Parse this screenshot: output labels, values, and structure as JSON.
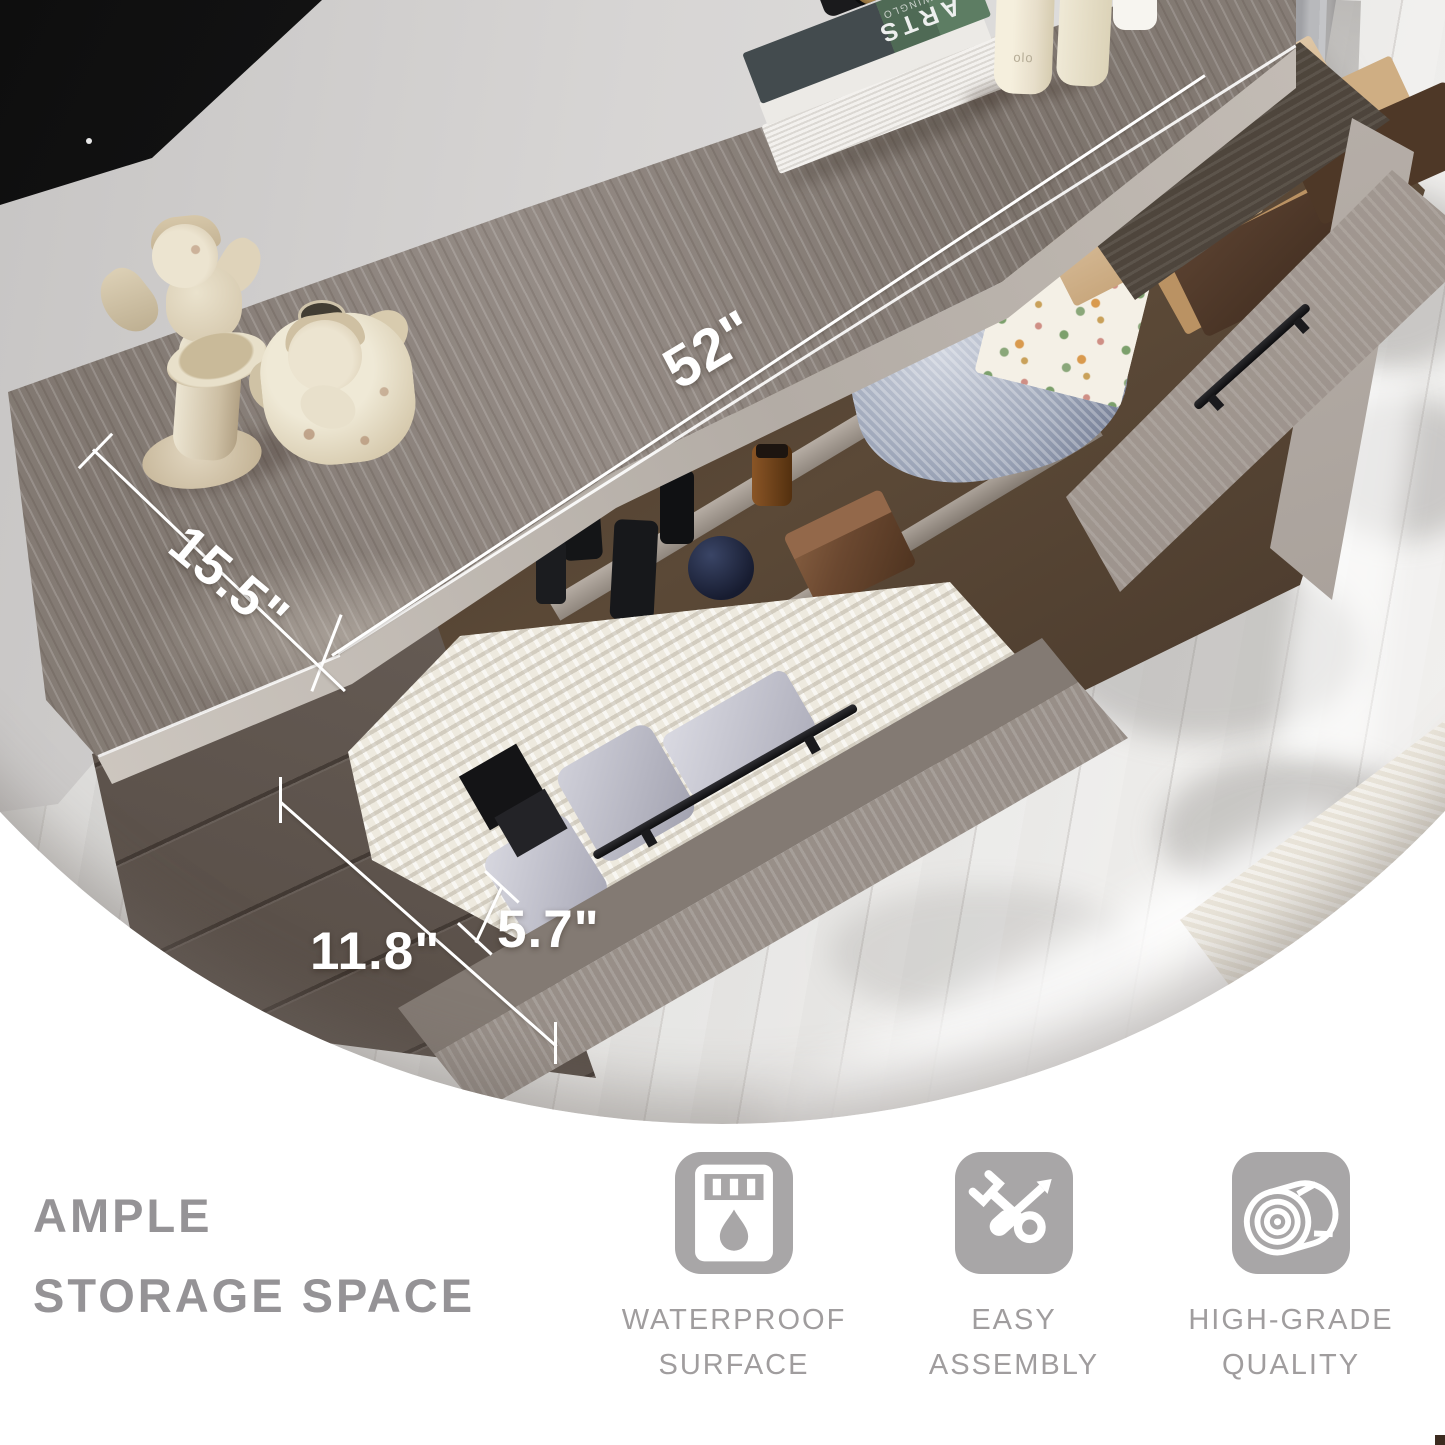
{
  "annotations": {
    "length": "52\"",
    "depth": "15.5\"",
    "height": "11.8\"",
    "drawer_height": "5.7\""
  },
  "headline": {
    "line1": "AMPLE",
    "line2": "STORAGE SPACE"
  },
  "features": [
    {
      "icon": "waterproof-icon",
      "line1": "WATERPROOF",
      "line2": "SURFACE"
    },
    {
      "icon": "assembly-icon",
      "line1": "EASY",
      "line2": "ASSEMBLY"
    },
    {
      "icon": "quality-icon",
      "line1": "HIGH-GRADE",
      "line2": "QUALITY"
    }
  ],
  "photo_props": {
    "book_title": "ARTS",
    "book_subtitle": "CHIWINGLO",
    "candle_brand": "olo"
  },
  "colors": {
    "headline_gray": "#959396",
    "feature_label_gray": "#a09d9e",
    "icon_background": "#a8a6a7",
    "annotation_white": "#ffffff",
    "tabletop_wood": "#8d8480",
    "cabinet_dark_wood": "#63594f",
    "floor": "#e3e2e0",
    "wall": "#d6d4d3",
    "towel_blue": "#9aa3b6",
    "kraft_box": "#cfae83",
    "curtain_gray": "#a9aaae"
  }
}
